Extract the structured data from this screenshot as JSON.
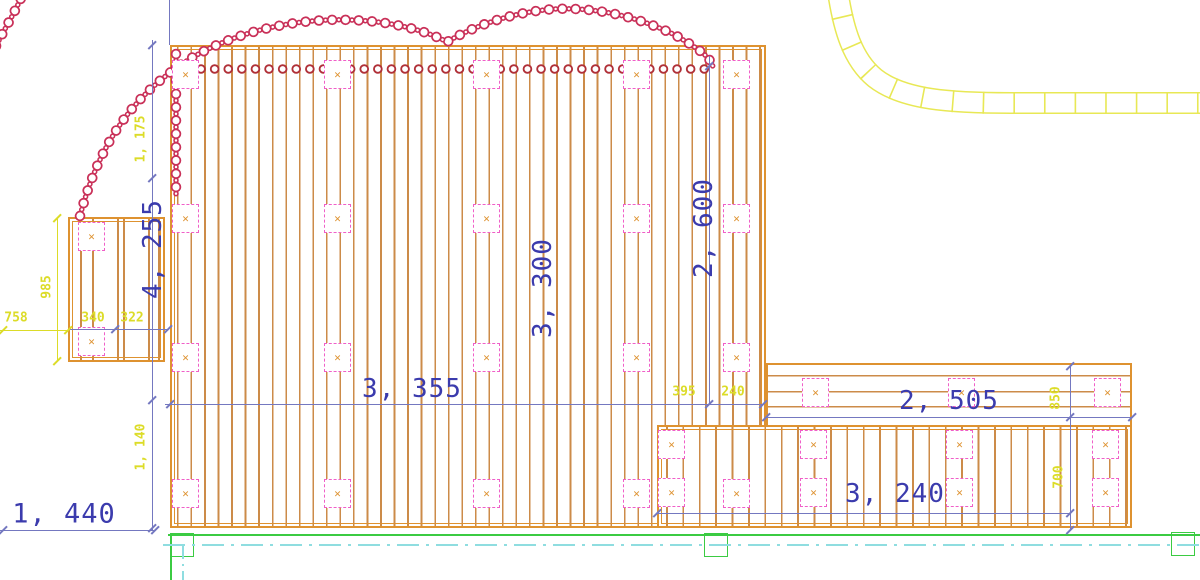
{
  "drawing": {
    "marker_glyph": "✕",
    "dims": {
      "total_height": "4, 255",
      "deck_width": "3, 355",
      "deck_height_inner": "3, 300",
      "right_col_height": "2, 600",
      "ext_top_width": "2, 505",
      "ext_bottom_width": "3, 240",
      "left_offset": "1, 440",
      "top_inset": "1, 175",
      "module_height": "985",
      "module_offset": "758",
      "module_bay_1": "340",
      "module_bay_2": "322",
      "step_bay_1": "395",
      "step_bay_2": "240",
      "ext_top_height": "850",
      "ext_bottom_height": "700",
      "bottom_inset": "1, 140"
    },
    "colors": {
      "plank": "#CC8B49",
      "frame": "#DE9230",
      "dim_text_primary": "#3B3BAD",
      "dim_text_secondary": "#DCDC28",
      "dim_line": "#7478C0",
      "marker": "#F05FC8",
      "chain": "#C93058",
      "scallop": "#B03038",
      "baseline": "#3BCB42",
      "centerline": "#8FDDE0",
      "path_band": "#E8E855"
    }
  }
}
